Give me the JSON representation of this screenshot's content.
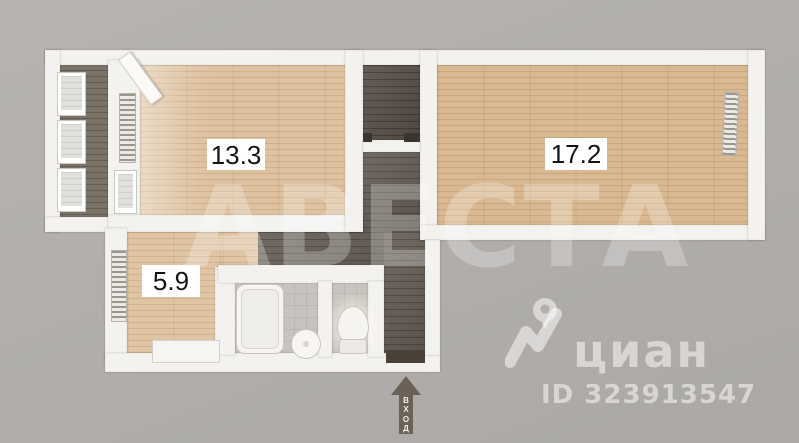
{
  "image": {
    "width": 799,
    "height": 443,
    "kind": "apartment-floor-plan"
  },
  "plan": {
    "rooms": [
      {
        "key": "living-room",
        "area_label": "13.3"
      },
      {
        "key": "bedroom",
        "area_label": "17.2"
      },
      {
        "key": "kitchen",
        "area_label": "5.9"
      }
    ],
    "entrance": {
      "label": "ВХОД",
      "letters": [
        "В",
        "Х",
        "О",
        "Д"
      ]
    }
  },
  "watermark": {
    "text": "АВЕСТА"
  },
  "brand": {
    "name": "циан",
    "listing_id": "ID 323913547",
    "logo_icon": "map-pin-icon"
  },
  "colors": {
    "background": "#b2afac",
    "wall": "#f3f2ef",
    "floor_wood_light": "#ddbf9b",
    "floor_wood_main": "#d8b68e",
    "floor_dark": "#68605f",
    "floor_balcony": "#7b7268",
    "floor_tile": "#c7c4bf",
    "entrance_arrow": "#6b6156",
    "label_bg": "#ffffff",
    "label_text": "#141414",
    "watermark_color": "rgba(255,255,255,0.26)",
    "brand_color": "rgba(255,255,255,0.52)"
  }
}
